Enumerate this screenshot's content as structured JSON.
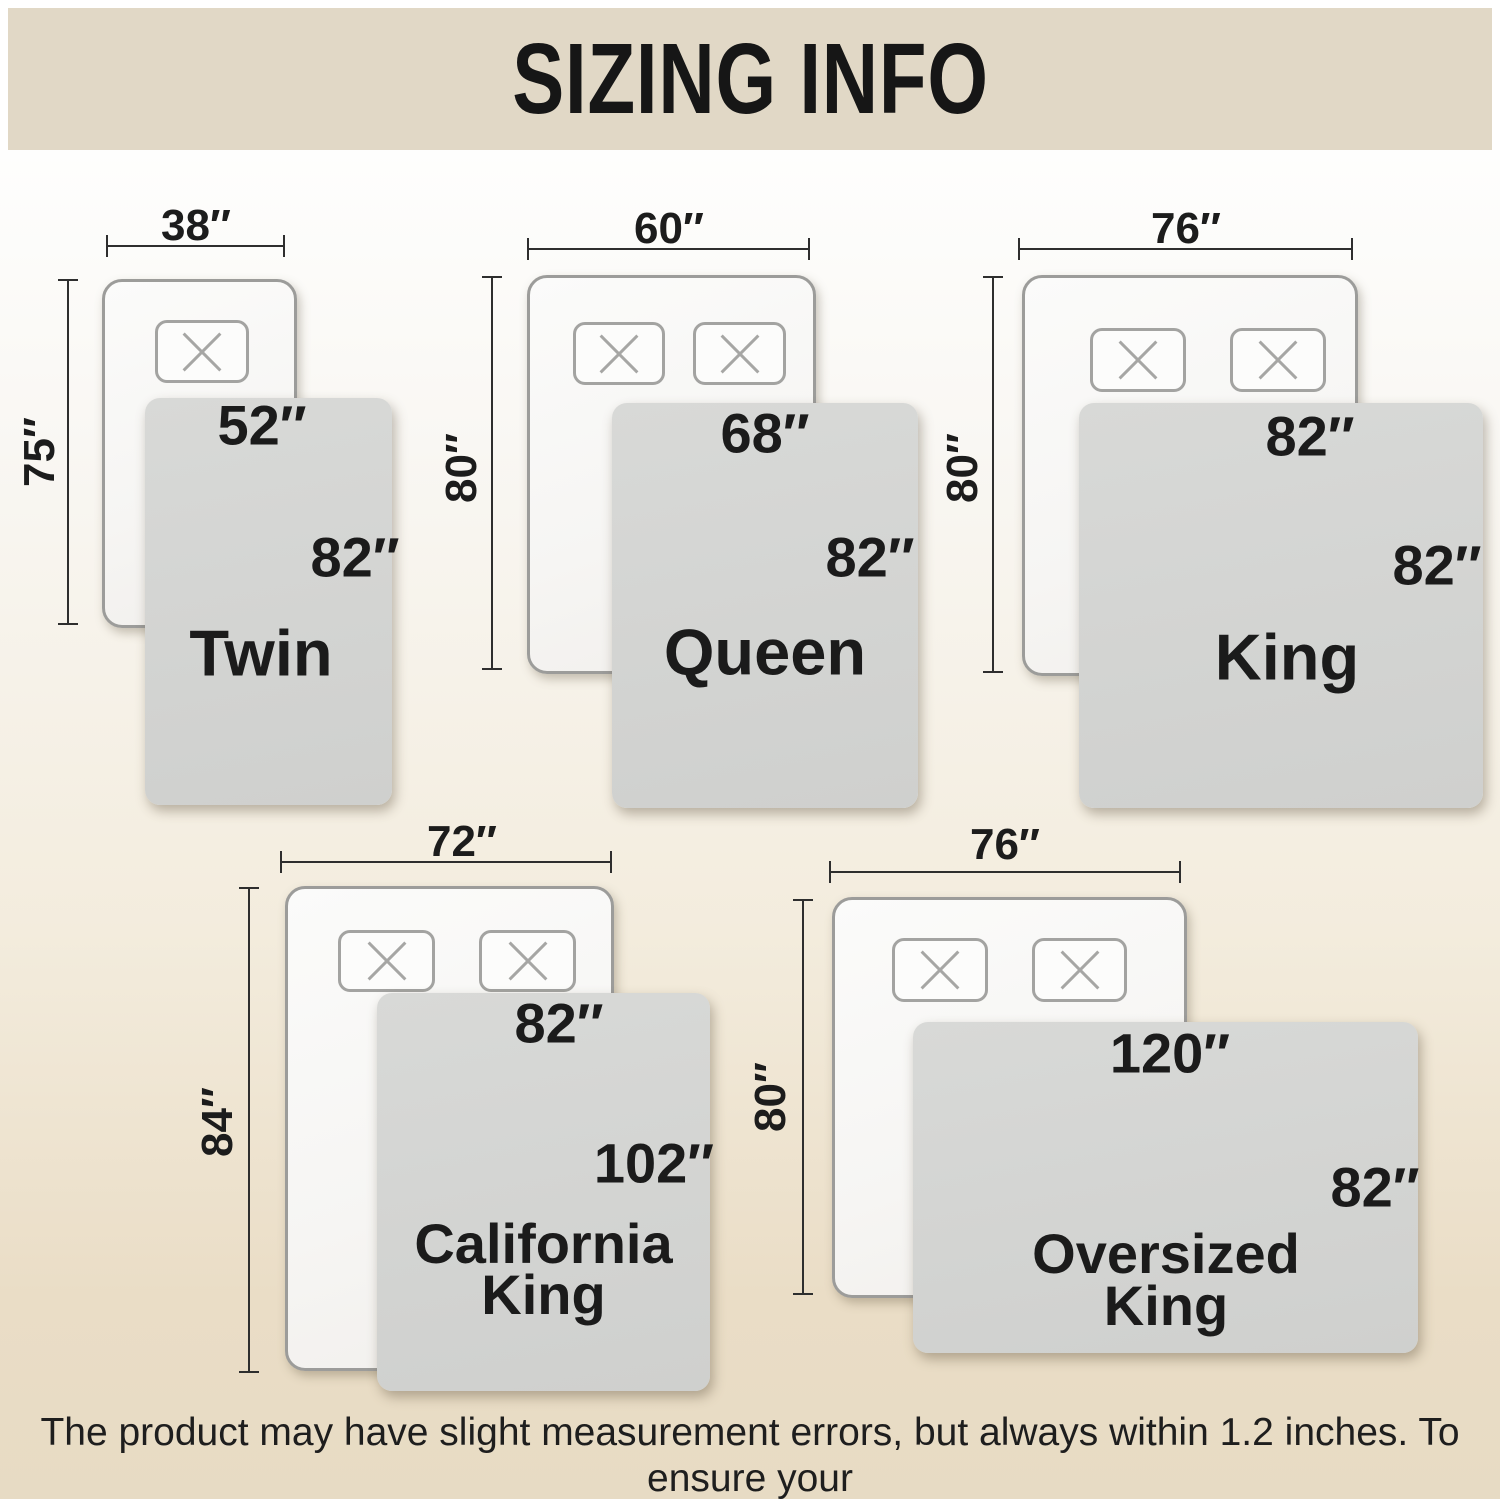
{
  "header": {
    "title": "SIZING INFO"
  },
  "sizes": [
    {
      "name": "Twin",
      "bed_width": "38″",
      "bed_length": "75″",
      "blanket_width": "52″",
      "blanket_length": "82″"
    },
    {
      "name": "Queen",
      "bed_width": "60″",
      "bed_length": "80″",
      "blanket_width": "68″",
      "blanket_length": "82″"
    },
    {
      "name": "King",
      "bed_width": "76″",
      "bed_length": "80″",
      "blanket_width": "82″",
      "blanket_length": "82″"
    },
    {
      "name": "California King",
      "bed_width": "72″",
      "bed_length": "84″",
      "blanket_width": "82″",
      "blanket_length": "102″"
    },
    {
      "name": "Oversized King",
      "bed_width": "76″",
      "bed_length": "80″",
      "blanket_width": "120″",
      "blanket_length": "82″"
    }
  ],
  "footer": {
    "line1": "The product may have slight measurement errors, but always within 1.2 inches. To ensure your",
    "line2": "satisfaction, consider ordering a larger size to cover more area."
  },
  "colors": {
    "banner_bg": "#e1d8c6",
    "background_bottom": "#e7dbc4",
    "blanket_gray": "#d4d5d3",
    "bed_border": "#9c9c9a",
    "text": "#1b1b1b"
  }
}
